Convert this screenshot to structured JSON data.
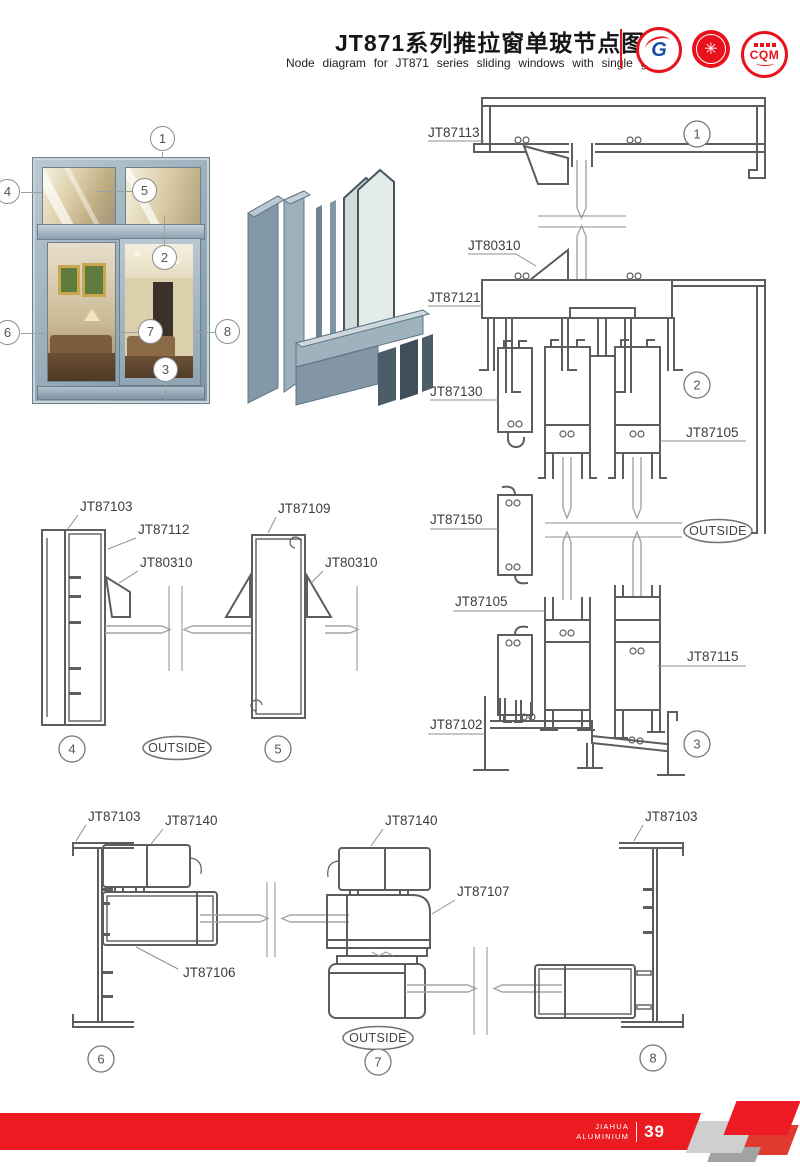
{
  "header": {
    "title": "JT871系列推拉窗单玻节点图",
    "subtitle": "Node diagram for JT871 series sliding windows with single glass",
    "logo_g_letter": "G",
    "logo_seal_glyph": "✳",
    "logo_cqm_text": "CQM"
  },
  "colors": {
    "accent_red": "#e8111c",
    "footer_red": "#ec1b22",
    "drawing_line_gray": "#5b5d5f",
    "aluminum_light": "#b9c8d1",
    "aluminum_dark": "#7e93a1"
  },
  "photo": {
    "callouts": {
      "c1": "1",
      "c2": "2",
      "c3": "3",
      "c4": "4",
      "c5": "5",
      "c6": "6",
      "c7": "7",
      "c8": "8"
    }
  },
  "section_right": {
    "jt87113": "JT87113",
    "jt80310": "JT80310",
    "jt87121": "JT87121",
    "jt87130": "JT87130",
    "jt87105_a": "JT87105",
    "jt87150": "JT87150",
    "outside": "OUTSIDE",
    "jt87105_b": "JT87105",
    "jt87115": "JT87115",
    "jt87102": "JT87102",
    "c1": "1",
    "c2": "2",
    "c3": "3"
  },
  "section_45": {
    "jt87103": "JT87103",
    "jt87112": "JT87112",
    "jt80310_a": "JT80310",
    "jt87109": "JT87109",
    "jt80310_b": "JT80310",
    "outside": "OUTSIDE",
    "c4": "4",
    "c5": "5"
  },
  "section_678": {
    "jt87103_a": "JT87103",
    "jt87140_a": "JT87140",
    "jt87140_b": "JT87140",
    "jt87103_b": "JT87103",
    "jt87107": "JT87107",
    "jt87106": "JT87106",
    "outside": "OUTSIDE",
    "c6": "6",
    "c7": "7",
    "c8": "8"
  },
  "footer": {
    "brand_line1": "JIAHUA",
    "brand_line2": "ALUMINIUM",
    "page_number": "39"
  }
}
